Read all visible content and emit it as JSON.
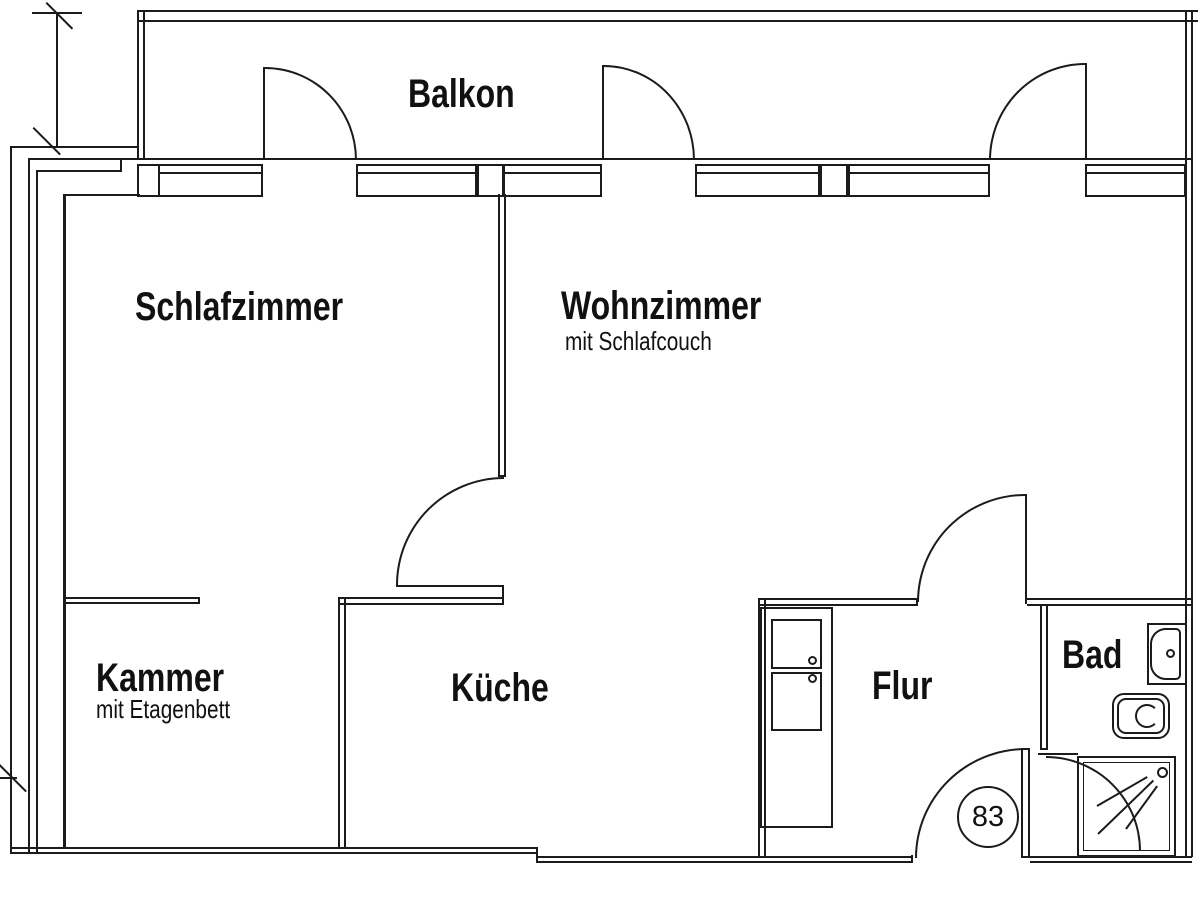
{
  "floorplan": {
    "rooms": {
      "balkon": {
        "label": "Balkon"
      },
      "schlafzimmer": {
        "label": "Schlafzimmer"
      },
      "wohnzimmer": {
        "label": "Wohnzimmer",
        "subtitle": "mit Schlafcouch"
      },
      "kammer": {
        "label": "Kammer",
        "subtitle": "mit Etagenbett"
      },
      "kueche": {
        "label": "Küche"
      },
      "flur": {
        "label": "Flur"
      },
      "bad": {
        "label": "Bad"
      }
    },
    "apartment_number": "83",
    "colors": {
      "line": "#1b1b1b",
      "background": "#ffffff"
    }
  }
}
